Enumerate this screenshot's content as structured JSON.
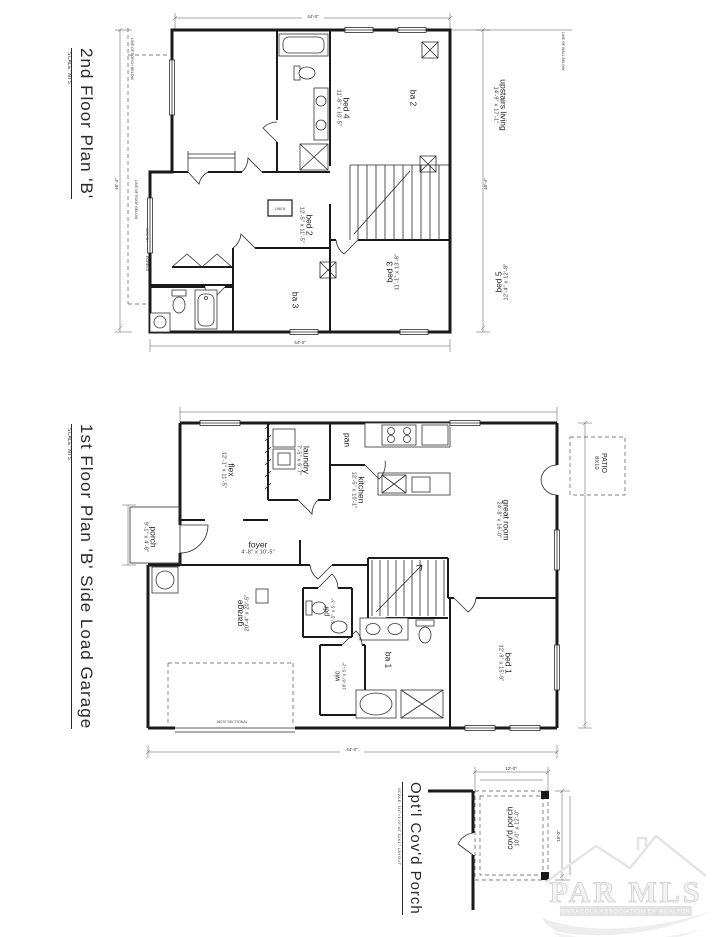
{
  "second_floor": {
    "title": "2nd Floor Plan 'B'",
    "scale": "SCALE: NTS",
    "rooms": {
      "bed4": {
        "name": "bed 4",
        "dims": "11'-8\" x 10'-5\""
      },
      "ba2": {
        "name": "ba 2",
        "dims": ""
      },
      "upstairs_living": {
        "name": "upstairs living",
        "dims": "14'-9\" x 17'-1\""
      },
      "bed2": {
        "name": "bed 2",
        "dims": "12'-5\" x 11'-5\""
      },
      "bed3": {
        "name": "bed 3",
        "dims": "11'-1\" x 13'-8\""
      },
      "ba3": {
        "name": "ba 3",
        "dims": ""
      },
      "bed5": {
        "name": "bed 5",
        "dims": "12'-4\" x 12'-8\""
      },
      "linen": {
        "name": "LINEN"
      }
    },
    "notes": {
      "porch_below": "LINE OF PORCH BELOW",
      "roof_below": "LINE OF ROOF BELOW",
      "wall_below": "LINE OF WALL BELOW",
      "window_tag": "3050 SH",
      "egress_tag": "EGRESS"
    },
    "dims": {
      "top": "44'-0\"",
      "left": "40'-4\"",
      "right": "40'-4\"",
      "bottom": "44'-0\""
    }
  },
  "first_floor": {
    "title": "1st Floor Plan 'B' Side Load Garage",
    "scale": "SCALE: NTS",
    "rooms": {
      "flex": {
        "name": "flex",
        "dims": "12'-1\" x 11'-5\""
      },
      "laundry": {
        "name": "laundry",
        "dims": "7'-5\" x 6'-7\""
      },
      "pan": {
        "name": "pan",
        "dims": ""
      },
      "kitchen": {
        "name": "kitchen",
        "dims": "12'-5\" x 10'-1\""
      },
      "foyer": {
        "name": "foyer",
        "dims": "4'-8\" x 10'-5\""
      },
      "porch": {
        "name": "porch",
        "dims": "9'-1\" x 4'-8\""
      },
      "great_room": {
        "name": "great room",
        "dims": "24'-8\" x 16'-0\""
      },
      "patio": {
        "name": "PATIO",
        "dims": "8X10"
      },
      "garage": {
        "name": "garage",
        "dims": "20'-4\" x 20'-5\""
      },
      "pdr": {
        "name": "pdr",
        "dims": "5'-5\" x 5'-3\""
      },
      "wic": {
        "name": "wic",
        "dims": "10'-6\" x 5'-2\""
      },
      "ba1": {
        "name": "ba 1",
        "dims": ""
      },
      "bed1": {
        "name": "bed 1",
        "dims": "12'-9\" x 15'-9\""
      }
    },
    "notes": {
      "garage_door": "16070 SECTIONAL"
    },
    "dims": {
      "bottom": "44'-0\""
    }
  },
  "porch_detail": {
    "title": "Opt'l Cov'd Porch",
    "scale": "SCALE: 1/4\"=1'-0\" AT 11X17 LAYOUT",
    "room": {
      "name": "cov'd porch",
      "dims": "10'-0\" x 12'-0\""
    },
    "dims": {
      "top": "12'-0\"",
      "right": "10'-0\""
    }
  },
  "watermark": {
    "text": "PAR MLS",
    "subtext": "PENSACOLA ASSOCIATION OF REALTORS"
  }
}
